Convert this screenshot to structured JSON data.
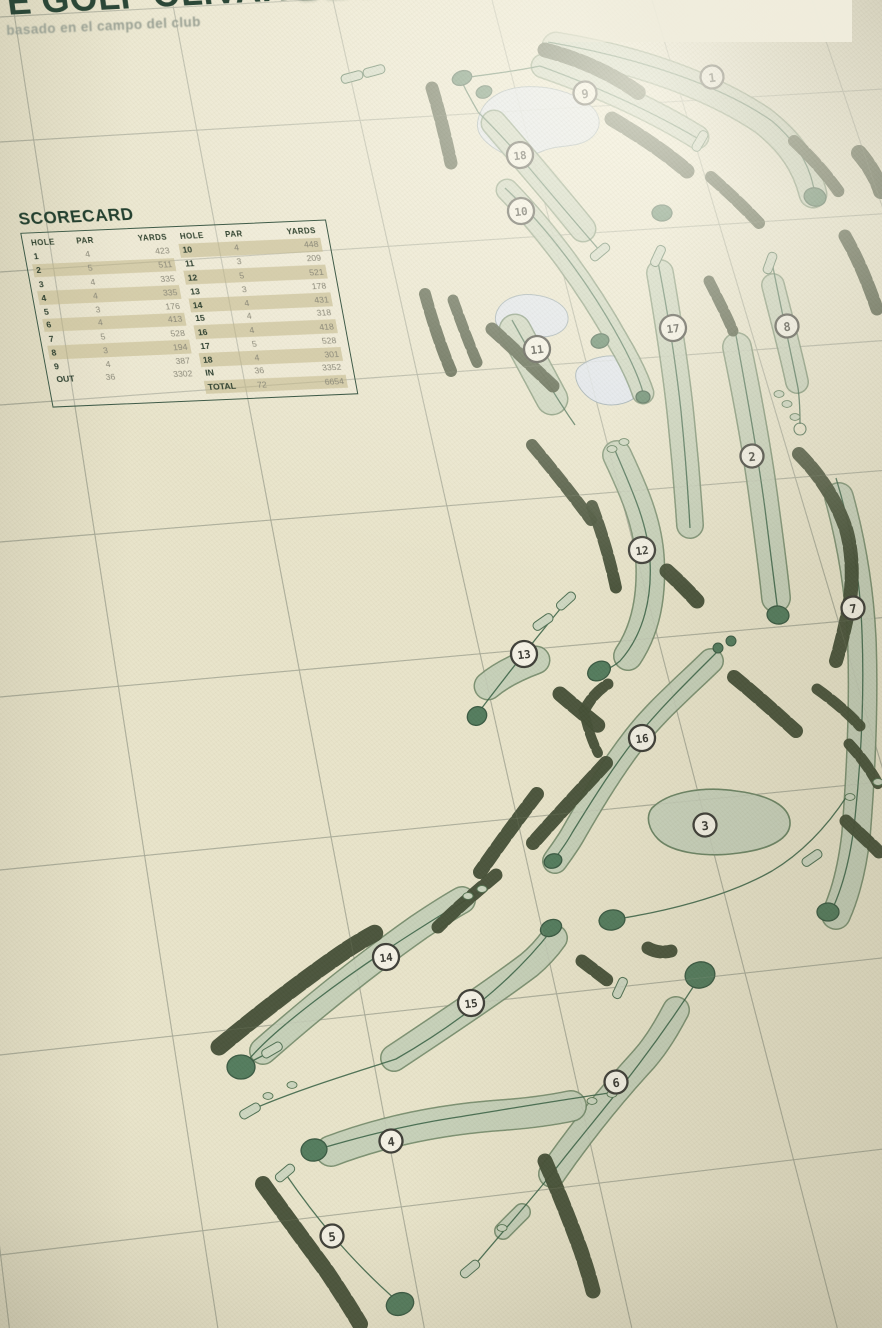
{
  "poster": {
    "title_part1": "E GOLF OLIVAR ",
    "title_part2": "DE LA",
    "subtitle": "basado en el campo del club"
  },
  "scorecard": {
    "title": "SCORECARD",
    "columns": [
      "HOLE",
      "PAR",
      "YARDS"
    ],
    "front_nine": {
      "rows": [
        [
          "1",
          "4",
          "423"
        ],
        [
          "2",
          "5",
          "511"
        ],
        [
          "3",
          "4",
          "335"
        ],
        [
          "4",
          "4",
          "335"
        ],
        [
          "5",
          "3",
          "176"
        ],
        [
          "6",
          "4",
          "413"
        ],
        [
          "7",
          "5",
          "528"
        ],
        [
          "8",
          "3",
          "194"
        ],
        [
          "9",
          "4",
          "387"
        ]
      ],
      "out_row": [
        "OUT",
        "36",
        "3302"
      ]
    },
    "back_nine": {
      "rows": [
        [
          "10",
          "4",
          "448"
        ],
        [
          "11",
          "3",
          "209"
        ],
        [
          "12",
          "5",
          "521"
        ],
        [
          "13",
          "3",
          "178"
        ],
        [
          "14",
          "4",
          "431"
        ],
        [
          "15",
          "4",
          "318"
        ],
        [
          "16",
          "4",
          "418"
        ],
        [
          "17",
          "5",
          "528"
        ],
        [
          "18",
          "4",
          "301"
        ]
      ],
      "in_row": [
        "IN",
        "36",
        "3352"
      ],
      "total_row": [
        "TOTAL",
        "72",
        "6654"
      ]
    }
  },
  "map": {
    "hole_markers": [
      {
        "label": "1",
        "x": 712,
        "y": 77
      },
      {
        "label": "9",
        "x": 585,
        "y": 93
      },
      {
        "label": "18",
        "x": 520,
        "y": 155
      },
      {
        "label": "10",
        "x": 521,
        "y": 211
      },
      {
        "label": "11",
        "x": 537,
        "y": 349
      },
      {
        "label": "17",
        "x": 673,
        "y": 328
      },
      {
        "label": "8",
        "x": 787,
        "y": 326
      },
      {
        "label": "2",
        "x": 752,
        "y": 456
      },
      {
        "label": "12",
        "x": 642,
        "y": 550
      },
      {
        "label": "7",
        "x": 853,
        "y": 608
      },
      {
        "label": "13",
        "x": 524,
        "y": 654
      },
      {
        "label": "16",
        "x": 642,
        "y": 738
      },
      {
        "label": "3",
        "x": 705,
        "y": 825
      },
      {
        "label": "14",
        "x": 386,
        "y": 957
      },
      {
        "label": "15",
        "x": 471,
        "y": 1003
      },
      {
        "label": "6",
        "x": 616,
        "y": 1082
      },
      {
        "label": "4",
        "x": 391,
        "y": 1141
      },
      {
        "label": "5",
        "x": 332,
        "y": 1236
      }
    ]
  },
  "colors": {
    "paper": "#e8e3c9",
    "ink_green": "#2b4737",
    "grid_line": "#a8aa97",
    "fairway": "#c7d1ba",
    "fairway_outline": "#66805f",
    "trees": "#414c33",
    "water": "#dde4ee",
    "water_outline": "#93a3ab",
    "green_fill": "#50795a",
    "green_outline": "#35563e",
    "marker_fill": "#f4f1e4",
    "marker_ring": "#3a3a33",
    "row_highlight": "#c1b989"
  }
}
